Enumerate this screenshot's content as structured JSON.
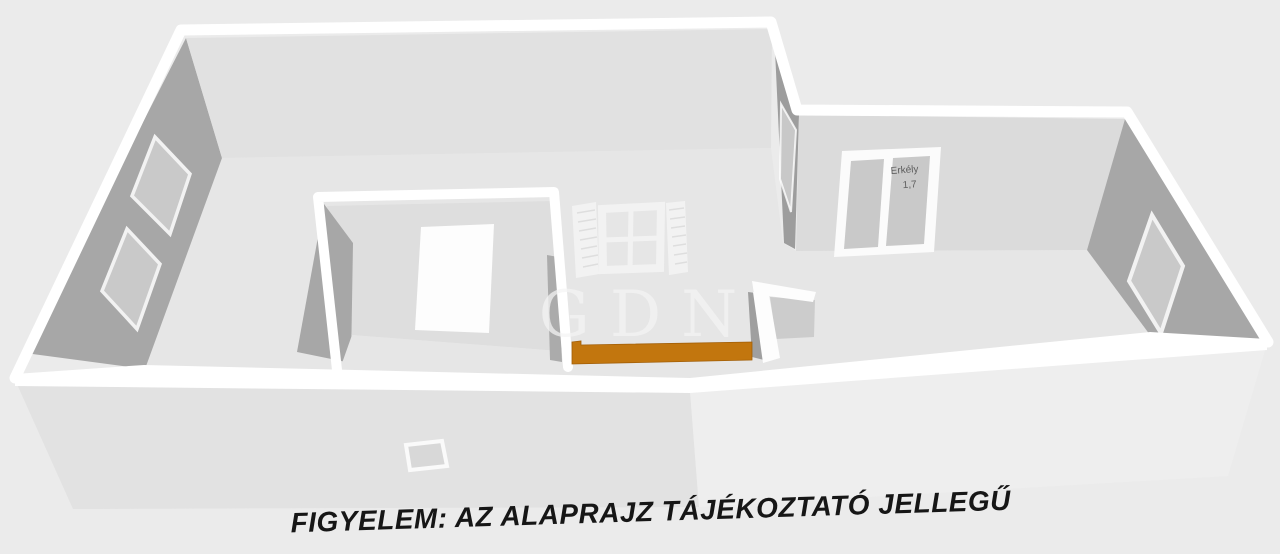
{
  "scene": {
    "caption": "FIGYELEM: AZ ALAPRAJZ TÁJÉKOZTATÓ JELLEGŰ",
    "watermark_text": "GDN",
    "balcony_label_line1": "Erkély",
    "balcony_label_line2": "1,7",
    "colors": {
      "background": "#ebebeb",
      "wall_top_white": "#ffffff",
      "wall_shaded_gray": "#a7a7a7",
      "wall_back_light": "#e1e1e1",
      "floor": "#e6e6e6",
      "window_glass": "#c9c9c9",
      "door_leaf_white": "#fdfdfd",
      "furniture_orange": "#c2760e",
      "caption_color": "#161616"
    }
  }
}
